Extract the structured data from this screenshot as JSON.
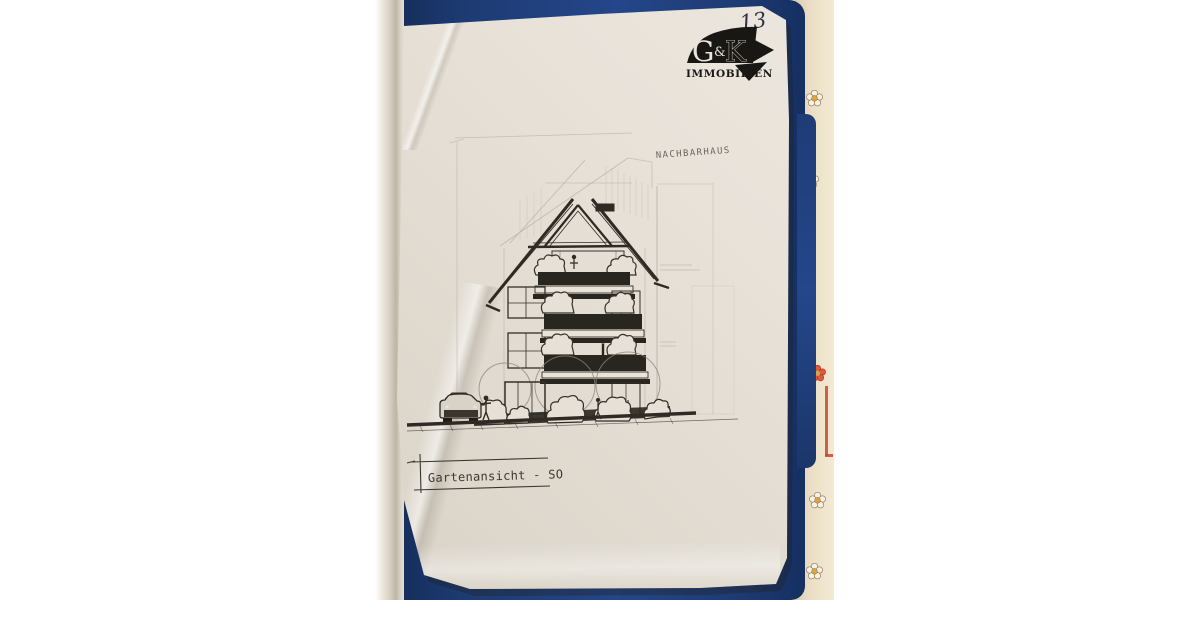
{
  "page": {
    "handwritten_number": "13"
  },
  "logo": {
    "g": "G",
    "amp": "&",
    "k": "K",
    "company": "IMMOBILIEN"
  },
  "drawing": {
    "neighbor_label": "NACHBARHAUS",
    "title": "Gartenansicht - SO"
  },
  "colors": {
    "folder_blue": "#1d3a72",
    "paper": "#e3ddd3",
    "ink": "#2f2a23",
    "tablecloth_cream": "#e9dfca",
    "flower_gold": "#d8a54c",
    "accent_red": "#cc4530"
  }
}
